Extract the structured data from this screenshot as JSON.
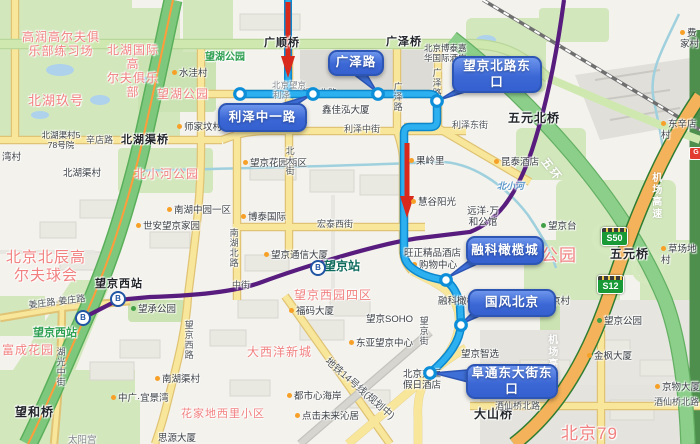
{
  "colors": {
    "bus_route": "#2cb0f0",
    "bus_route_casing": "#0c86cc",
    "driving_route": "#d9291c",
    "callout_fill": "#3c68d6",
    "callout_border": "#2c55b4",
    "metro_line": "#571c7e",
    "expressway_green": "#7ec87e",
    "ring5_green": "#8ccf8a",
    "airport_expwy_orange": "#f4b35a",
    "road_yellow": "#f8e79b",
    "park_green": "#d3e7bd",
    "pink_label": "#f18080",
    "shield_green": "#199a37"
  },
  "callouts": [
    {
      "id": "guangze-road",
      "t": "广泽路",
      "x": 328,
      "y": 50,
      "w": 52,
      "h": 22,
      "tail": [
        348,
        70,
        364,
        70,
        377,
        92
      ]
    },
    {
      "id": "wangjing-north-road-east-stop",
      "t": "望京北路东\n口",
      "x": 452,
      "y": 56,
      "w": 86,
      "h": 33,
      "tail": [
        460,
        87,
        478,
        88,
        439,
        100
      ]
    },
    {
      "id": "lize-zhongyi-road-stop",
      "t": "利泽中一路",
      "x": 218,
      "y": 103,
      "w": 85,
      "h": 25,
      "tail": [
        278,
        105,
        296,
        105,
        311,
        95
      ]
    },
    {
      "id": "rongke-olive-city-stop",
      "t": "融科橄榄城",
      "x": 466,
      "y": 236,
      "w": 74,
      "h": 25,
      "tail": [
        471,
        259,
        488,
        259,
        447,
        278
      ]
    },
    {
      "id": "guofeng-beijing-stop",
      "t": "国风北京",
      "x": 468,
      "y": 289,
      "w": 84,
      "h": 24,
      "tail": [
        474,
        311,
        491,
        311,
        461,
        324
      ]
    },
    {
      "id": "futong-east-street-east-stop",
      "t": "阜通东大街东\n口",
      "x": 466,
      "y": 364,
      "w": 88,
      "h": 31,
      "tail": [
        468,
        370,
        468,
        382,
        433,
        373
      ]
    }
  ],
  "route_nodes": [
    [
      240,
      94
    ],
    [
      313,
      94
    ],
    [
      378,
      94
    ],
    [
      437,
      101
    ],
    [
      446,
      280
    ],
    [
      461,
      325
    ],
    [
      430,
      373
    ]
  ],
  "stations": {
    "glyph": "B",
    "items": [
      [
        318,
        268
      ],
      [
        118,
        299
      ],
      [
        83,
        318
      ]
    ]
  },
  "shields": [
    {
      "t": "S50",
      "x": 601,
      "y": 227
    },
    {
      "t": "S12",
      "x": 597,
      "y": 275
    }
  ],
  "badges": [
    {
      "t": "G",
      "x": 689,
      "y": 147
    }
  ],
  "labels": [
    {
      "t": "高润高尔夫俱\n乐部练习场",
      "x": 22,
      "y": 30,
      "c": "pink",
      "w": 78
    },
    {
      "t": "北湖国际高\n尔夫俱乐部",
      "x": 102,
      "y": 43,
      "c": "pink",
      "w": 62
    },
    {
      "t": "北湖玖号",
      "x": 28,
      "y": 93,
      "c": "pink",
      "s": 13
    },
    {
      "t": "望湖公园",
      "x": 157,
      "y": 87,
      "c": "pink"
    },
    {
      "t": "望湖公园",
      "x": 205,
      "y": 52,
      "c": "green"
    },
    {
      "t": "水洼村",
      "x": 172,
      "y": 68,
      "d": "o"
    },
    {
      "t": "师家坟村",
      "x": 177,
      "y": 122,
      "d": "o"
    },
    {
      "t": "北湖渠村5\n78号院",
      "x": 38,
      "y": 130,
      "s": 8.5,
      "w": 46
    },
    {
      "t": "辛店路",
      "x": 86,
      "y": 135,
      "c": "road"
    },
    {
      "t": "北湖渠桥",
      "x": 121,
      "y": 134,
      "c": "bridge"
    },
    {
      "t": "湾村",
      "x": 2,
      "y": 152
    },
    {
      "t": "北湖渠村",
      "x": 63,
      "y": 168
    },
    {
      "t": "广顺桥",
      "x": 264,
      "y": 37,
      "c": "bridge"
    },
    {
      "t": "广泽桥",
      "x": 386,
      "y": 36,
      "c": "bridge"
    },
    {
      "t": "北京博泰嘉\n华国际酒店",
      "x": 424,
      "y": 43,
      "s": 8.5
    },
    {
      "t": "费家村",
      "x": 680,
      "y": 28,
      "d": "o"
    },
    {
      "t": "东辛店村",
      "x": 661,
      "y": 119,
      "d": "o"
    },
    {
      "t": "五元北桥",
      "x": 508,
      "y": 111,
      "c": "bridge",
      "s": 12
    },
    {
      "t": "北京望京",
      "x": 272,
      "y": 80,
      "c": "dim",
      "s": 8.5
    },
    {
      "t": "利泽",
      "x": 273,
      "y": 90,
      "c": "dim",
      "s": 8.5
    },
    {
      "t": "望京北路",
      "x": 301,
      "y": 88,
      "c": "road",
      "u": 1
    },
    {
      "t": "鑫佳泓大厦",
      "x": 322,
      "y": 105
    },
    {
      "t": "利泽中街",
      "x": 344,
      "y": 124,
      "c": "road"
    },
    {
      "t": "利泽东街",
      "x": 452,
      "y": 120,
      "c": "road",
      "u": 1
    },
    {
      "t": "广泽路",
      "x": 392,
      "y": 82,
      "c": "vroad"
    },
    {
      "t": "广泽路",
      "x": 431,
      "y": 68,
      "c": "vroad",
      "u": 1
    },
    {
      "t": "昆泰酒店",
      "x": 494,
      "y": 157,
      "d": "o"
    },
    {
      "t": "望京花园西区",
      "x": 243,
      "y": 158,
      "d": "o"
    },
    {
      "t": "果岭里",
      "x": 409,
      "y": 156,
      "d": "o"
    },
    {
      "t": "慧谷阳光",
      "x": 411,
      "y": 197,
      "d": "o"
    },
    {
      "t": "北小河公园",
      "x": 134,
      "y": 167,
      "c": "pink"
    },
    {
      "t": "南湖中园一区",
      "x": 167,
      "y": 205,
      "d": "o"
    },
    {
      "t": "世安望京家园",
      "x": 136,
      "y": 221,
      "d": "o"
    },
    {
      "t": "博泰国际",
      "x": 241,
      "y": 212,
      "d": "o"
    },
    {
      "t": "宏泰西街",
      "x": 317,
      "y": 219,
      "c": "road"
    },
    {
      "t": "北大街",
      "x": 284,
      "y": 146,
      "c": "vroad"
    },
    {
      "t": "南湖北路",
      "x": 228,
      "y": 228,
      "c": "vroad"
    },
    {
      "t": "望京台",
      "x": 541,
      "y": 221,
      "d": "g"
    },
    {
      "t": "远洋·万\n和公馆",
      "x": 463,
      "y": 206,
      "w": 40
    },
    {
      "t": "北小河",
      "x": 497,
      "y": 181,
      "c": "river"
    },
    {
      "t": "草场地村",
      "x": 661,
      "y": 244,
      "d": "o"
    },
    {
      "t": "五环",
      "x": 548,
      "y": 156,
      "c": "hwy",
      "r": 52
    },
    {
      "t": "机场高速",
      "x": 649,
      "y": 172,
      "c": "vhwy"
    },
    {
      "t": "机场高速",
      "x": 545,
      "y": 334,
      "c": "vhwy"
    },
    {
      "t": "五元桥",
      "x": 610,
      "y": 247,
      "c": "bridge",
      "s": 12
    },
    {
      "t": "望京通信大厦",
      "x": 264,
      "y": 250,
      "d": "o"
    },
    {
      "t": "旺正精品酒店",
      "x": 404,
      "y": 248
    },
    {
      "t": "购物中心",
      "x": 412,
      "y": 260,
      "d": "o",
      "u": 1
    },
    {
      "t": "望京站",
      "x": 324,
      "y": 259,
      "c": "metro"
    },
    {
      "t": "望京西站",
      "x": 95,
      "y": 278,
      "c": "bridge"
    },
    {
      "t": "北京北辰高\n尔夫球会",
      "x": 0,
      "y": 249,
      "c": "pink",
      "s": 15,
      "w": 92
    },
    {
      "t": "望京西园四区",
      "x": 294,
      "y": 288,
      "c": "pink"
    },
    {
      "t": "融科橄榄城",
      "x": 438,
      "y": 296
    },
    {
      "t": "大望京村",
      "x": 532,
      "y": 296
    },
    {
      "t": "望京公园",
      "x": 505,
      "y": 246,
      "c": "pink",
      "s": 17
    },
    {
      "t": "望京公园",
      "x": 597,
      "y": 316,
      "d": "g"
    },
    {
      "t": "姜庄路·姜庄路",
      "x": 28,
      "y": 300,
      "c": "road",
      "r": -7
    },
    {
      "t": "望承公园",
      "x": 131,
      "y": 304,
      "d": "g"
    },
    {
      "t": "望京西站",
      "x": 33,
      "y": 327,
      "c": "green",
      "s": 11
    },
    {
      "t": "富成花园",
      "x": 2,
      "y": 343,
      "c": "pink"
    },
    {
      "t": "湖光中街",
      "x": 55,
      "y": 347,
      "c": "vroad"
    },
    {
      "t": "望京西路",
      "x": 183,
      "y": 320,
      "c": "vroad"
    },
    {
      "t": "中街",
      "x": 232,
      "y": 280,
      "c": "road"
    },
    {
      "t": "福码大厦",
      "x": 289,
      "y": 306,
      "d": "o"
    },
    {
      "t": "望京SOHO",
      "x": 366,
      "y": 314
    },
    {
      "t": "东亚望京中心",
      "x": 349,
      "y": 338,
      "d": "o"
    },
    {
      "t": "大西洋新城",
      "x": 247,
      "y": 345,
      "c": "pink"
    },
    {
      "t": "望京智选",
      "x": 461,
      "y": 349
    },
    {
      "t": "望京街",
      "x": 418,
      "y": 316,
      "c": "vroad",
      "u": 1
    },
    {
      "t": "地铁14号线(规划中)",
      "x": 330,
      "y": 356,
      "c": "road",
      "r": 41,
      "s": 10
    },
    {
      "t": "南湖渠村",
      "x": 155,
      "y": 374,
      "d": "o"
    },
    {
      "t": "中广·宜景湾",
      "x": 111,
      "y": 393,
      "d": "o"
    },
    {
      "t": "都市心海岸",
      "x": 287,
      "y": 391,
      "d": "o"
    },
    {
      "t": "点击未来沁居",
      "x": 295,
      "y": 411,
      "d": "o"
    },
    {
      "t": "北京方恒\n假日酒店",
      "x": 396,
      "y": 369,
      "w": 52
    },
    {
      "t": "花家地西里小区",
      "x": 181,
      "y": 408,
      "c": "pink",
      "s": 11
    },
    {
      "t": "望和桥",
      "x": 15,
      "y": 405,
      "c": "bridge",
      "s": 12
    },
    {
      "t": "太阳宫",
      "x": 68,
      "y": 435,
      "c": "dim"
    },
    {
      "t": "思源大厦",
      "x": 158,
      "y": 433
    },
    {
      "t": "大山桥",
      "x": 474,
      "y": 407,
      "c": "bridge",
      "s": 12
    },
    {
      "t": "金枫大厦",
      "x": 587,
      "y": 351,
      "d": "o"
    },
    {
      "t": "京物大厦",
      "x": 655,
      "y": 382,
      "d": "o"
    },
    {
      "t": "酒仙桥北路",
      "x": 495,
      "y": 401,
      "c": "road"
    },
    {
      "t": "酒仙桥北路",
      "x": 654,
      "y": 397,
      "c": "road"
    },
    {
      "t": "北京79",
      "x": 561,
      "y": 424,
      "c": "pink",
      "s": 17
    }
  ]
}
